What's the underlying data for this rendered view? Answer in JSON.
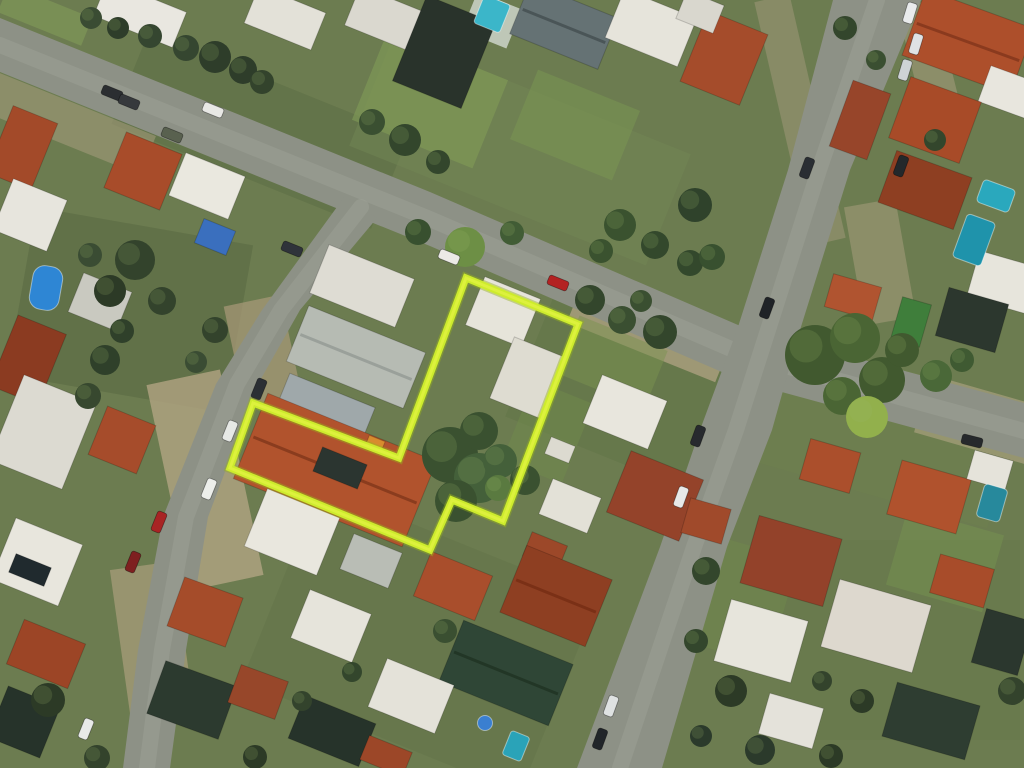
{
  "scene": {
    "width": 1024,
    "height": 768,
    "description": "aerial-photo-with-parcel-outline",
    "palette": {
      "ground_base": "#6c7c50",
      "asphalt": "#8d9186",
      "asphalt_worn": "#9ea295",
      "boundary_main": "#cdeb2d",
      "boundary_glow": "#96b21c",
      "boundary_core": "#dff23f"
    },
    "legend": {
      "ground": [
        "cx",
        "cy",
        "w",
        "h",
        "rot",
        "fill",
        "opacity"
      ],
      "buildings": [
        "cx",
        "cy",
        "w",
        "h",
        "rot",
        "fill",
        "ridge(optional)"
      ],
      "trees": [
        "cx",
        "cy",
        "r",
        "fill"
      ],
      "pools": [
        "cx",
        "cy",
        "w",
        "h",
        "rot",
        "fill",
        "rx"
      ],
      "cars": [
        "cx",
        "cy",
        "rot",
        "fill"
      ]
    },
    "ground": [
      [
        260,
        130,
        280,
        100,
        22,
        "#5c6d45",
        0.55
      ],
      [
        520,
        150,
        320,
        120,
        22,
        "#718553",
        0.5
      ],
      [
        130,
        310,
        220,
        170,
        10,
        "#55663f",
        0.5
      ],
      [
        640,
        390,
        230,
        150,
        22,
        "#5f7346",
        0.5
      ],
      [
        430,
        100,
        130,
        95,
        22,
        "#7f9a56",
        0.65
      ],
      [
        575,
        125,
        110,
        75,
        22,
        "#7a9552",
        0.55
      ],
      [
        880,
        430,
        260,
        130,
        16,
        "#6d7f4e",
        0.5
      ],
      [
        900,
        640,
        240,
        200,
        0,
        "#66784a",
        0.5
      ],
      [
        420,
        640,
        300,
        210,
        22,
        "#5e7044",
        0.35
      ],
      [
        45,
        15,
        90,
        30,
        22,
        "#7d9456",
        0.8
      ],
      [
        205,
        480,
        75,
        210,
        -12,
        "#b2a482",
        0.8
      ],
      [
        263,
        352,
        58,
        105,
        -12,
        "#a99a79",
        0.7
      ],
      [
        650,
        330,
        160,
        48,
        22,
        "#b1a383",
        0.75
      ],
      [
        800,
        120,
        36,
        250,
        -13,
        "#a39a7c",
        0.5
      ],
      [
        930,
        62,
        38,
        120,
        -14,
        "#a89d7d",
        0.55
      ],
      [
        60,
        120,
        190,
        42,
        22,
        "#a79c7d",
        0.55
      ],
      [
        152,
        640,
        64,
        150,
        -8,
        "#b0a280",
        0.65
      ],
      [
        880,
        262,
        52,
        120,
        -10,
        "#ab9f7f",
        0.5
      ],
      [
        492,
        20,
        48,
        42,
        22,
        "#c8cfc2",
        0.9
      ],
      [
        740,
        600,
        90,
        110,
        16,
        "#70884c",
        0.5
      ],
      [
        548,
        432,
        64,
        86,
        22,
        "#6f8a4c",
        0.5
      ],
      [
        612,
        362,
        95,
        62,
        22,
        "#7a9150",
        0.5
      ],
      [
        945,
        560,
        100,
        80,
        16,
        "#769250",
        0.5
      ],
      [
        980,
        420,
        120,
        60,
        16,
        "#b3a685",
        0.6
      ]
    ],
    "roads": [
      {
        "name": "avenue-diagonal",
        "points": "0,18 430,192 745,328 1024,403 1024,458 745,382 430,246 0,72",
        "center": "M0,45 L430,219 745,355 1024,431"
      },
      {
        "name": "street-right",
        "points": "833,0 788,170 737,330 700,430 660,547 577,768 662,768 727,547 772,430 800,330 850,170 921,0",
        "center": "M877,0 L819,170 768,330 736,430 694,547 620,768"
      },
      {
        "name": "street-left",
        "points": "345,196 262,310 216,384 163,517 138,650 123,768 170,768 186,650 208,517 258,384 300,310 377,218",
        "center": "M361,207 L281,310 237,384 186,517 162,650 147,768"
      }
    ],
    "buildings": [
      [
        140,
        14,
        85,
        38,
        22,
        "#e9e7e0"
      ],
      [
        285,
        18,
        72,
        40,
        22,
        "#e3e1d8"
      ],
      [
        383,
        18,
        66,
        42,
        22,
        "#dad8cf"
      ],
      [
        444,
        52,
        74,
        92,
        22,
        "#29332b"
      ],
      [
        564,
        26,
        95,
        55,
        22,
        "#657274",
        "#4a5557"
      ],
      [
        651,
        28,
        78,
        52,
        22,
        "#e6e4db"
      ],
      [
        724,
        58,
        64,
        76,
        22,
        "#a54c2b"
      ],
      [
        700,
        12,
        40,
        30,
        22,
        "#d9d7ce"
      ],
      [
        968,
        42,
        115,
        70,
        20,
        "#ad4f2b",
        "#8a3a1e"
      ],
      [
        1008,
        92,
        50,
        38,
        20,
        "#e8e6de"
      ],
      [
        935,
        120,
        75,
        65,
        20,
        "#a84b28"
      ],
      [
        860,
        120,
        40,
        70,
        20,
        "#97452a"
      ],
      [
        925,
        190,
        80,
        55,
        20,
        "#8e3f22"
      ],
      [
        1002,
        282,
        60,
        48,
        16,
        "#e7e5dc"
      ],
      [
        972,
        320,
        62,
        50,
        16,
        "#2c372e"
      ],
      [
        911,
        322,
        30,
        44,
        16,
        "#3f7e3b"
      ],
      [
        853,
        297,
        50,
        34,
        16,
        "#b05430"
      ],
      [
        22,
        148,
        48,
        72,
        22,
        "#a34a29"
      ],
      [
        30,
        215,
        58,
        55,
        22,
        "#e7e5dd"
      ],
      [
        28,
        360,
        52,
        76,
        22,
        "#8b3b21"
      ],
      [
        143,
        171,
        60,
        60,
        22,
        "#a84c2a"
      ],
      [
        207,
        186,
        64,
        46,
        22,
        "#eae8df"
      ],
      [
        215,
        237,
        34,
        26,
        22,
        "#3a6fbe"
      ],
      [
        100,
        302,
        52,
        42,
        22,
        "#c9c9c0"
      ],
      [
        43,
        432,
        78,
        92,
        22,
        "#dcdad1"
      ],
      [
        122,
        440,
        52,
        52,
        22,
        "#a64c2b"
      ],
      [
        37,
        562,
        72,
        66,
        22,
        "#e8e6dd"
      ],
      [
        30,
        570,
        38,
        20,
        22,
        "#202a2e"
      ],
      [
        46,
        654,
        66,
        48,
        22,
        "#9c4526"
      ],
      [
        24,
        722,
        56,
        55,
        22,
        "#26332a"
      ],
      [
        205,
        612,
        62,
        52,
        20,
        "#a54c2a"
      ],
      [
        192,
        700,
        76,
        56,
        20,
        "#2c3a2f"
      ],
      [
        258,
        692,
        50,
        40,
        20,
        "#97472a"
      ],
      [
        362,
        286,
        92,
        52,
        22,
        "#dedcd3"
      ],
      [
        356,
        357,
        126,
        60,
        22,
        "#b6bbb3",
        "#9aa09a"
      ],
      [
        503,
        312,
        60,
        52,
        22,
        "#e6e4da"
      ],
      [
        528,
        378,
        56,
        66,
        22,
        "#dedcd1"
      ],
      [
        325,
        409,
        92,
        40,
        22,
        "#9fa8aa"
      ],
      [
        335,
        470,
        182,
        92,
        22,
        "#b1532d",
        "#8a3c1e"
      ],
      [
        340,
        468,
        48,
        26,
        22,
        "#2b3530"
      ],
      [
        375,
        444,
        17,
        12,
        22,
        "#d88c2e"
      ],
      [
        625,
        412,
        70,
        52,
        22,
        "#e8e6dd"
      ],
      [
        560,
        450,
        26,
        18,
        22,
        "#dcdad0"
      ],
      [
        570,
        506,
        52,
        38,
        22,
        "#e3e1d7"
      ],
      [
        655,
        496,
        78,
        66,
        22,
        "#94432a"
      ],
      [
        545,
        551,
        38,
        26,
        22,
        "#9c4829"
      ],
      [
        292,
        532,
        78,
        62,
        22,
        "#e9e7de"
      ],
      [
        371,
        561,
        52,
        38,
        22,
        "#b9bdb5"
      ],
      [
        453,
        586,
        66,
        48,
        22,
        "#a94e2c"
      ],
      [
        556,
        596,
        92,
        72,
        22,
        "#8e3f22",
        "#7a3016"
      ],
      [
        331,
        626,
        66,
        52,
        22,
        "#e6e4db"
      ],
      [
        506,
        673,
        118,
        66,
        22,
        "#2f4636",
        "#223626"
      ],
      [
        411,
        696,
        72,
        52,
        22,
        "#e4e2d9"
      ],
      [
        332,
        731,
        76,
        46,
        22,
        "#26332a"
      ],
      [
        386,
        756,
        46,
        26,
        22,
        "#9c4728"
      ],
      [
        830,
        466,
        52,
        42,
        16,
        "#ab4f2c"
      ],
      [
        929,
        497,
        72,
        56,
        16,
        "#b0522d"
      ],
      [
        990,
        470,
        40,
        30,
        16,
        "#e5e3da"
      ],
      [
        791,
        561,
        86,
        70,
        16,
        "#93422a"
      ],
      [
        761,
        641,
        80,
        64,
        16,
        "#e7e5dc"
      ],
      [
        876,
        626,
        95,
        70,
        16,
        "#ddd8ce"
      ],
      [
        962,
        581,
        56,
        40,
        16,
        "#a84c2a"
      ],
      [
        1002,
        642,
        48,
        56,
        16,
        "#2b372e"
      ],
      [
        931,
        721,
        86,
        56,
        16,
        "#2e3d31"
      ],
      [
        791,
        721,
        56,
        42,
        16,
        "#e4e2da"
      ],
      [
        706,
        521,
        42,
        36,
        16,
        "#a04a2b"
      ]
    ],
    "pools": [
      [
        492,
        14,
        28,
        30,
        22,
        "#3bb6c9",
        3
      ],
      [
        46,
        288,
        30,
        44,
        10,
        "#2e86d4",
        12
      ],
      [
        996,
        196,
        34,
        24,
        20,
        "#2aa8bd",
        4
      ],
      [
        974,
        240,
        30,
        46,
        20,
        "#1f93ab",
        4
      ],
      [
        516,
        746,
        20,
        26,
        22,
        "#2aa3b8",
        3
      ],
      [
        485,
        723,
        15,
        15,
        0,
        "#3a7fd0",
        8
      ],
      [
        992,
        503,
        24,
        34,
        16,
        "#27899c",
        4
      ]
    ],
    "trees": [
      [
        215,
        57,
        16,
        "#2e3d2a"
      ],
      [
        186,
        48,
        13,
        "#354630"
      ],
      [
        243,
        70,
        14,
        "#2e3d2a"
      ],
      [
        150,
        36,
        12,
        "#354630"
      ],
      [
        118,
        28,
        11,
        "#2e3d2a"
      ],
      [
        91,
        18,
        11,
        "#3a4c33"
      ],
      [
        262,
        82,
        12,
        "#33432c"
      ],
      [
        405,
        140,
        16,
        "#33462c"
      ],
      [
        372,
        122,
        13,
        "#3a4f31"
      ],
      [
        438,
        162,
        12,
        "#33462c"
      ],
      [
        465,
        247,
        20,
        "#6d8f45"
      ],
      [
        418,
        232,
        13,
        "#38502f"
      ],
      [
        512,
        233,
        12,
        "#415c35"
      ],
      [
        620,
        225,
        16,
        "#3a522f"
      ],
      [
        655,
        245,
        14,
        "#33482c"
      ],
      [
        601,
        251,
        12,
        "#3a522f"
      ],
      [
        690,
        263,
        13,
        "#33482c"
      ],
      [
        695,
        205,
        17,
        "#2f422b"
      ],
      [
        712,
        257,
        13,
        "#38502f"
      ],
      [
        815,
        355,
        30,
        "#41592f"
      ],
      [
        855,
        338,
        25,
        "#4a6534"
      ],
      [
        882,
        380,
        23,
        "#41592f"
      ],
      [
        842,
        396,
        19,
        "#4a6534"
      ],
      [
        867,
        417,
        21,
        "#92b04c"
      ],
      [
        902,
        350,
        17,
        "#41592f"
      ],
      [
        590,
        300,
        15,
        "#33462c"
      ],
      [
        622,
        320,
        14,
        "#3a4f31"
      ],
      [
        660,
        332,
        17,
        "#33462c"
      ],
      [
        641,
        301,
        11,
        "#3a4f31"
      ],
      [
        450,
        455,
        28,
        "#3a5130"
      ],
      [
        479,
        478,
        25,
        "#44603a"
      ],
      [
        456,
        501,
        21,
        "#3a5130"
      ],
      [
        500,
        461,
        17,
        "#44603a"
      ],
      [
        479,
        431,
        19,
        "#3a5130"
      ],
      [
        498,
        488,
        13,
        "#5a7a40"
      ],
      [
        525,
        480,
        15,
        "#3a5130"
      ],
      [
        135,
        260,
        20,
        "#33432c"
      ],
      [
        110,
        291,
        16,
        "#2c3a26"
      ],
      [
        162,
        301,
        14,
        "#33432c"
      ],
      [
        90,
        255,
        12,
        "#3a4c33"
      ],
      [
        105,
        360,
        15,
        "#2f402a"
      ],
      [
        88,
        396,
        13,
        "#37482f"
      ],
      [
        122,
        331,
        12,
        "#2f402a"
      ],
      [
        215,
        330,
        13,
        "#33432c"
      ],
      [
        196,
        362,
        11,
        "#3a4c33"
      ],
      [
        48,
        700,
        17,
        "#2c3a26"
      ],
      [
        97,
        758,
        13,
        "#33432c"
      ],
      [
        255,
        757,
        12,
        "#2c3a26"
      ],
      [
        302,
        701,
        10,
        "#33432c"
      ],
      [
        445,
        631,
        12,
        "#3a4f31"
      ],
      [
        352,
        672,
        10,
        "#33462c"
      ],
      [
        706,
        571,
        14,
        "#33462c"
      ],
      [
        731,
        691,
        16,
        "#2c3a26"
      ],
      [
        696,
        641,
        12,
        "#33462c"
      ],
      [
        1012,
        691,
        14,
        "#33432c"
      ],
      [
        862,
        701,
        12,
        "#2c3a26"
      ],
      [
        822,
        681,
        10,
        "#33432c"
      ],
      [
        936,
        376,
        16,
        "#4a6838"
      ],
      [
        962,
        360,
        12,
        "#3f5a32"
      ],
      [
        845,
        28,
        12,
        "#33462c"
      ],
      [
        876,
        60,
        10,
        "#3a4f31"
      ],
      [
        935,
        140,
        11,
        "#33462c"
      ],
      [
        760,
        750,
        15,
        "#2b3a2b"
      ],
      [
        831,
        756,
        12,
        "#2c3a26"
      ],
      [
        701,
        736,
        11,
        "#2b3a2b"
      ]
    ],
    "cars": [
      [
        112,
        93,
        22,
        "#2b2e31"
      ],
      [
        129,
        102,
        22,
        "#36393c"
      ],
      [
        213,
        110,
        22,
        "#e8e8e5"
      ],
      [
        172,
        135,
        22,
        "#59614f"
      ],
      [
        292,
        249,
        22,
        "#2f333a"
      ],
      [
        449,
        257,
        22,
        "#eceae6"
      ],
      [
        558,
        283,
        22,
        "#b32222"
      ],
      [
        972,
        441,
        14,
        "#26292c"
      ],
      [
        910,
        13,
        -73,
        "#e9ebec"
      ],
      [
        916,
        44,
        -73,
        "#dfe2e4"
      ],
      [
        905,
        70,
        -73,
        "#ced3d5"
      ],
      [
        901,
        166,
        -70,
        "#24282b"
      ],
      [
        807,
        168,
        -70,
        "#2a2e33"
      ],
      [
        767,
        308,
        -70,
        "#1f2327"
      ],
      [
        698,
        436,
        -70,
        "#272a2e"
      ],
      [
        681,
        497,
        -70,
        "#e7e9e8"
      ],
      [
        611,
        706,
        -70,
        "#dfe2e2"
      ],
      [
        600,
        739,
        -70,
        "#212529"
      ],
      [
        259,
        389,
        -68,
        "#2b2f34"
      ],
      [
        230,
        431,
        -68,
        "#e6e8e5"
      ],
      [
        209,
        489,
        -68,
        "#eceeea"
      ],
      [
        159,
        522,
        -68,
        "#a82424"
      ],
      [
        133,
        562,
        -68,
        "#7e2020"
      ],
      [
        86,
        729,
        -68,
        "#e8eae8"
      ]
    ],
    "boundary": {
      "points": "466,278 578,324 503,521 452,500 430,550 230,468 253,403 399,458",
      "stroke_main": "#cdeb2d",
      "stroke_glow": "#96b21c",
      "stroke_core": "#dff23f",
      "width_main": 7,
      "width_glow": 10,
      "width_core": 3
    }
  }
}
